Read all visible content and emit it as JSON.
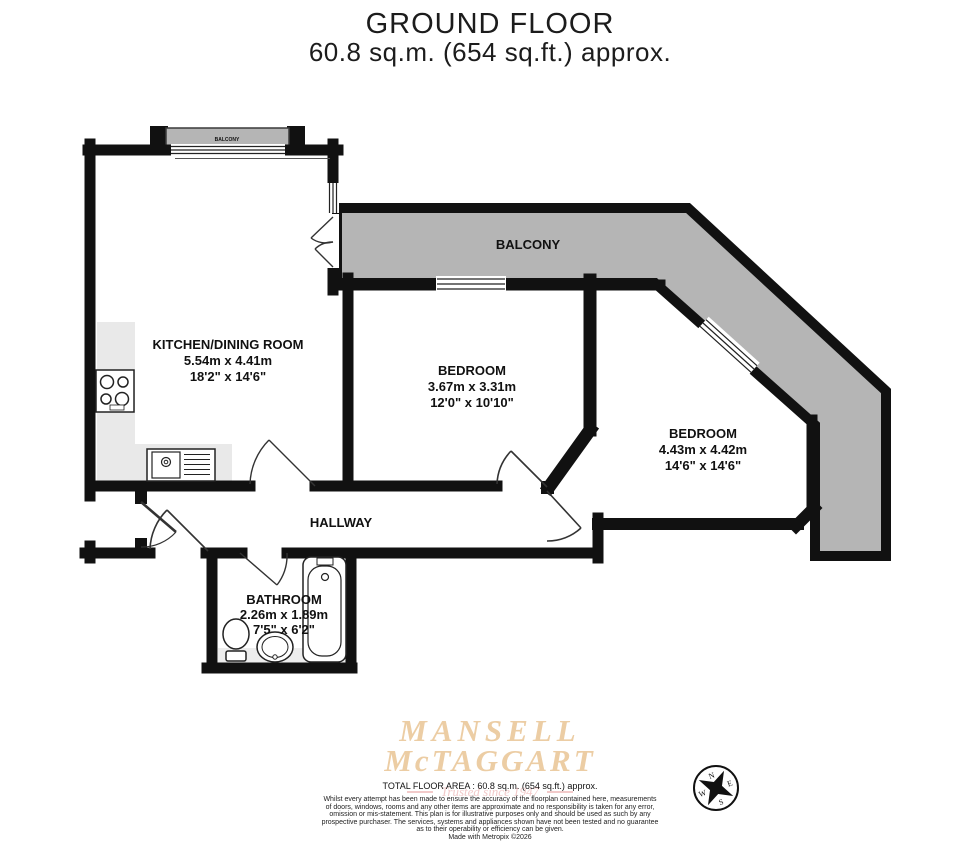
{
  "title": {
    "line1": "GROUND FLOOR",
    "line2": "60.8 sq.m. (654 sq.ft.) approx."
  },
  "rooms": {
    "kitchen": {
      "name": "KITCHEN/DINING ROOM",
      "metric": "5.54m x 4.41m",
      "imperial": "18'2\" x 14'6\""
    },
    "bedroom1": {
      "name": "BEDROOM",
      "metric": "3.67m x 3.31m",
      "imperial": "12'0\" x 10'10\""
    },
    "bedroom2": {
      "name": "BEDROOM",
      "metric": "4.43m x 4.42m",
      "imperial": "14'6\" x 14'6\""
    },
    "bathroom": {
      "name": "BATHROOM",
      "metric": "2.26m x 1.89m",
      "imperial": "7'5\" x 6'2\""
    },
    "hallway": {
      "name": "HALLWAY"
    },
    "balcony": {
      "name": "BALCONY"
    },
    "juliet_balcony": {
      "name": "BALCONY"
    }
  },
  "compass": {
    "north": "N",
    "east": "E",
    "south": "S",
    "west": "W"
  },
  "footer": {
    "brand_line1": "MANSELL",
    "brand_line2": "McTAGGART",
    "tagline": "Trusted since 1947",
    "total_area": "TOTAL FLOOR AREA : 60.8 sq.m. (654 sq.ft.) approx.",
    "disclaimer_lines": [
      "Whilst every attempt has been made to ensure the accuracy of the floorplan contained here, measurements",
      "of doors, windows, rooms and any other items are approximate and no responsibility is taken for any error,",
      "omission or mis-statement. This plan is for illustrative purposes only and should be used as such by any",
      "prospective purchaser. The services, systems and appliances shown have not been tested and no guarantee",
      "as to their operability or efficiency can be given."
    ],
    "credit": "Made with Metropix ©2026"
  },
  "colors": {
    "wall": "#111111",
    "balcony_fill": "#b5b5b5",
    "counter_fill": "#e9e9e9",
    "brand": "#eccda4",
    "tagline": "#f2caca"
  }
}
